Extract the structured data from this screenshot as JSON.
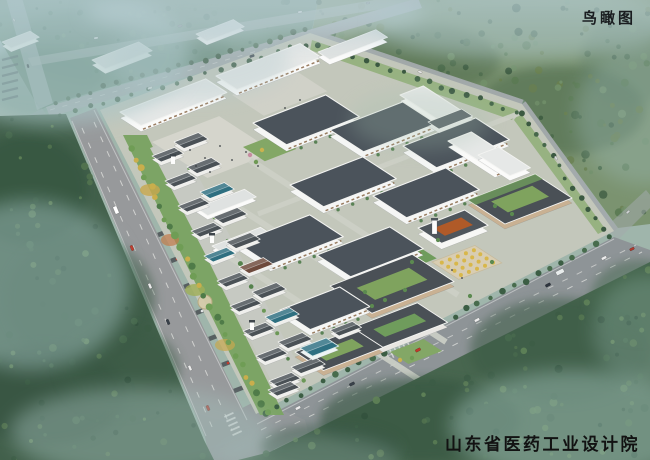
{
  "labels": {
    "view_type": "鸟瞰图",
    "credit": "山东省医药工业设计院"
  },
  "scene": {
    "palette": {
      "sky_haze": "#bad0d8",
      "forest_dark": "#31503c",
      "forest_light": "#5f8157",
      "forest_mist": "#9dbcba",
      "road_surface": "#97999b",
      "roof_dark_slate": "#4b535b",
      "roof_light": "#e6e8e7",
      "wall_white": "#f5f6f5",
      "lawn_green": "#7ca465",
      "courtyard_green": "#7fa35e",
      "accent_orange": "#b05a28",
      "accent_teal_roof": "#2e7082",
      "tree_yellow": "#c9ae4c",
      "label_text": "#1a1d20"
    }
  }
}
